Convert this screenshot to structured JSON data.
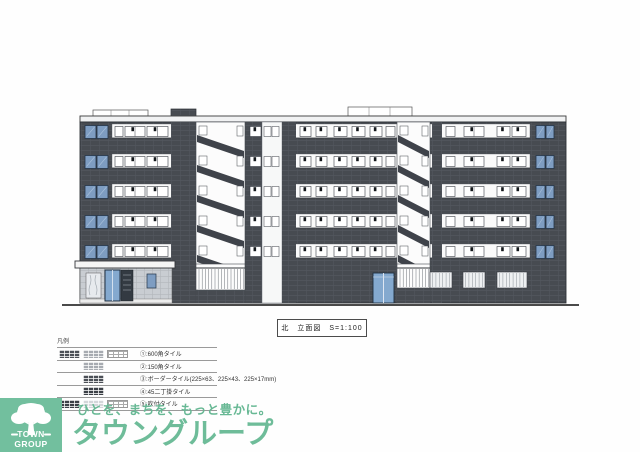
{
  "drawing": {
    "title_name": "北　立面図",
    "scale": "S=1:100",
    "colors": {
      "wall_dark": "#474b51",
      "floor_band_white": "#fafafa",
      "end_window_blue": "#7e9dc2",
      "entrance_glass_blue": "#84a9cf",
      "entrance_tile_gray": "#c9cdd2"
    }
  },
  "legend": {
    "label": "凡例",
    "rows": [
      {
        "text": "①:600角タイル",
        "swatches": [
          "tile-dark-grid",
          "tile-medium-grid",
          "tile-white-grid"
        ]
      },
      {
        "text": "②:150角タイル",
        "swatches": [
          "tile-medium-grid"
        ]
      },
      {
        "text": "③:ボーダータイル(225×63、225×43、225×17mm)",
        "swatches": [
          "tile-dark-grid"
        ]
      },
      {
        "text": "④:45二丁掛タイル",
        "swatches": [
          "tile-darker-grid"
        ]
      },
      {
        "text": "⑤:吹付タイル",
        "swatches": [
          "tile-dark-grid",
          "tile-light",
          "tile-white-grid"
        ]
      }
    ]
  },
  "logo": {
    "square_label": "TOWN GROUP",
    "tagline": "ひとを、まちを、もっと豊かに。",
    "brand": "タウングループ",
    "brand_color": "#6ebc99"
  }
}
